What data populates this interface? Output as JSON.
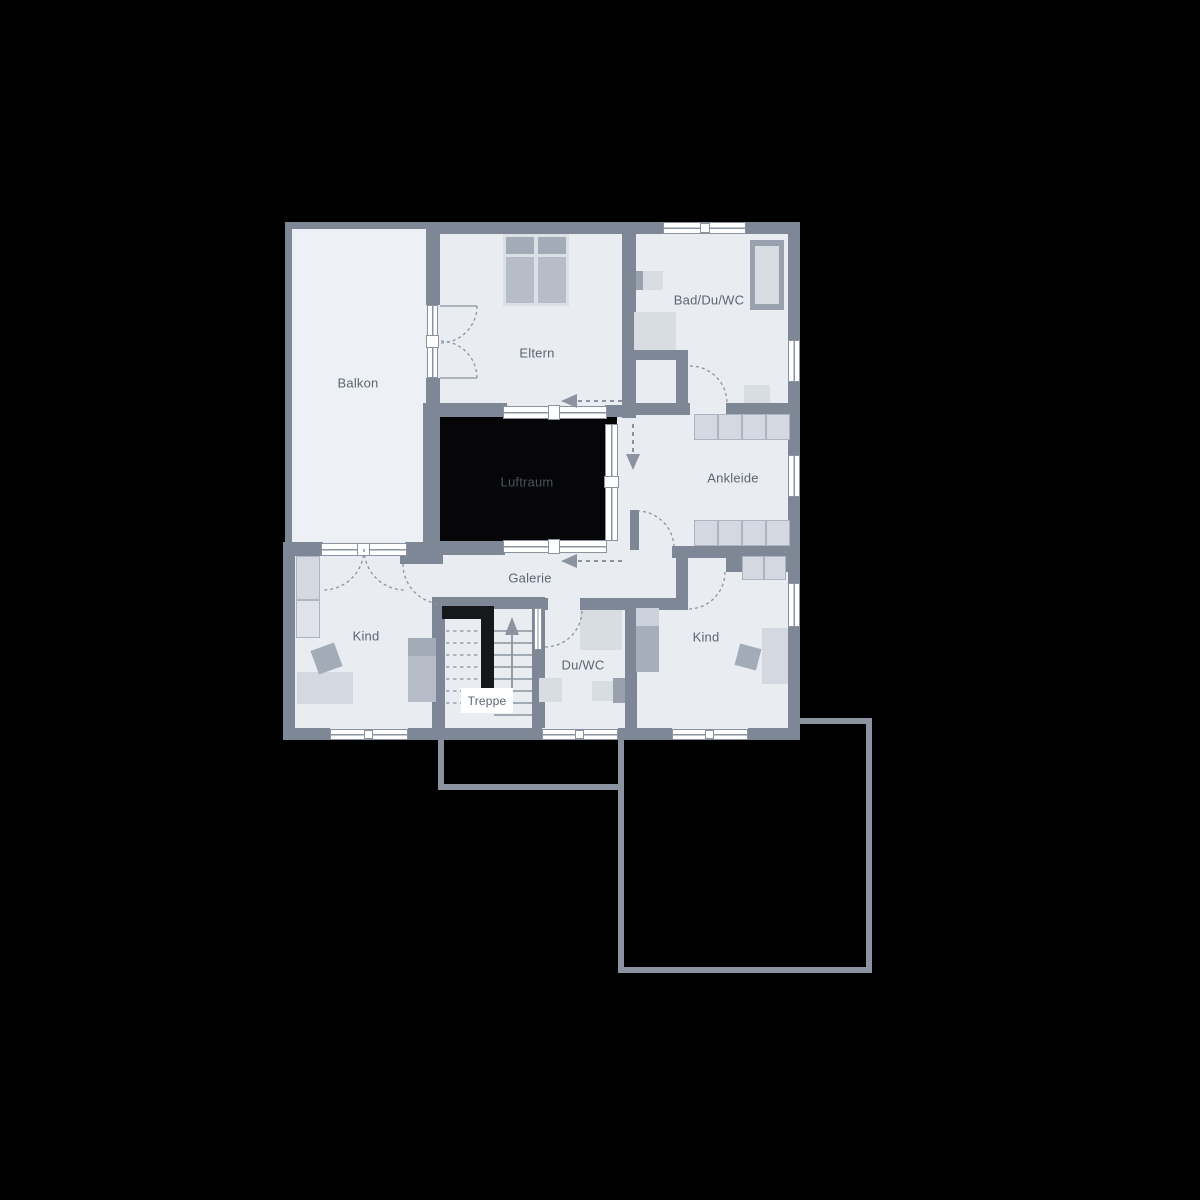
{
  "rooms": {
    "balkon": "Balkon",
    "eltern": "Eltern",
    "bad": "Bad/Du/WC",
    "luftraum": "Luftraum",
    "ankleide": "Ankleide",
    "galerie": "Galerie",
    "kind_links": "Kind",
    "treppe": "Treppe",
    "duwc": "Du/WC",
    "kind_rechts": "Kind"
  },
  "colors": {
    "background": "#000000",
    "floor": "#e9ecf1",
    "balcony_floor": "#edf0f4",
    "wall": "#7e8795",
    "line": "#8b93a0",
    "outline": "#8c93a0",
    "window": "#ffffff",
    "void": "#060608",
    "void_label": "#49515e",
    "label_text": "#5c6572",
    "furniture_light": "#d4d9e1",
    "furniture_mid": "#b6bdc9",
    "furniture_dark": "#a3abb9",
    "cell_border": "#adb4c1",
    "fixture": "#d8dce3",
    "fixture_dark": "#99a1af",
    "bed_frame": "#dbe0e7",
    "pillow_light": "#ccd2db",
    "bed_body_dark": "#a6aebb",
    "stair_dark": "#17181c"
  }
}
